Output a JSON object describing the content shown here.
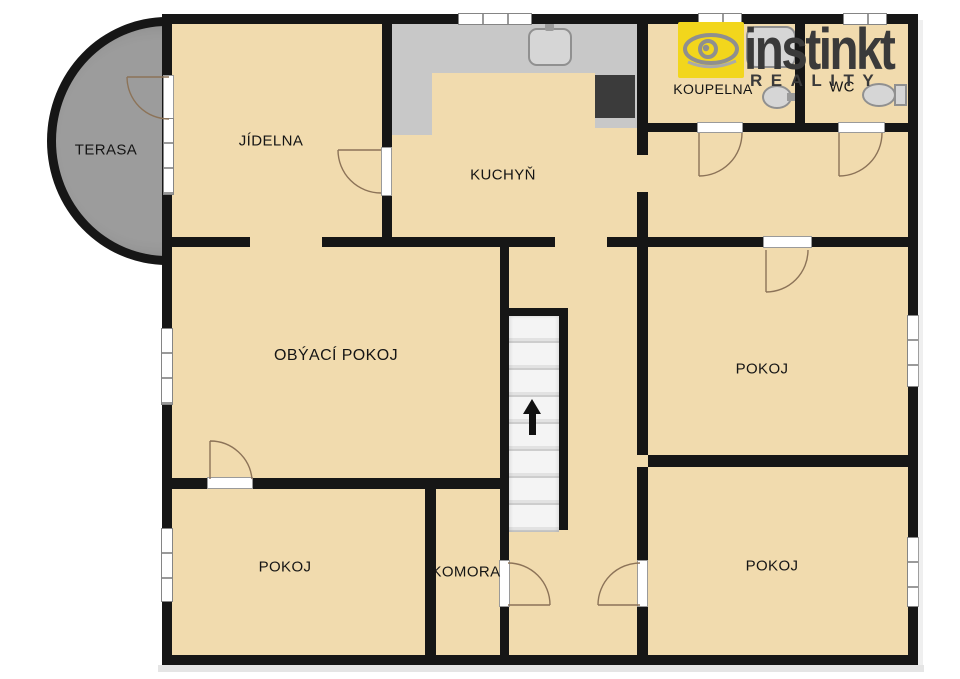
{
  "brand": {
    "name": "instinkt",
    "subtitle": "REALITY"
  },
  "rooms": {
    "terasa": {
      "label": "TERASA"
    },
    "jidelna": {
      "label": "JÍDELNA"
    },
    "kuchyn": {
      "label": "KUCHYŇ"
    },
    "koupelna": {
      "label": "KOUPELNA"
    },
    "wc": {
      "label": "WC"
    },
    "obyvaci_pokoj": {
      "label": "OBÝACÍ POKOJ"
    },
    "pokoj_top_right": {
      "label": "POKOJ"
    },
    "pokoj_bottom_left": {
      "label": "POKOJ"
    },
    "pokoj_bottom_right": {
      "label": "POKOJ"
    },
    "komora": {
      "label": "KOMORA"
    }
  },
  "colors": {
    "floor": "#f1dbae",
    "wall": "#161616",
    "terrace": "#9c9c9c",
    "counter": "#c8c8c8",
    "stove": "#3b3b3b",
    "brand_yellow": "#f2d61c",
    "brand_dark": "#3a3a3a",
    "arc": "#8c7358"
  }
}
